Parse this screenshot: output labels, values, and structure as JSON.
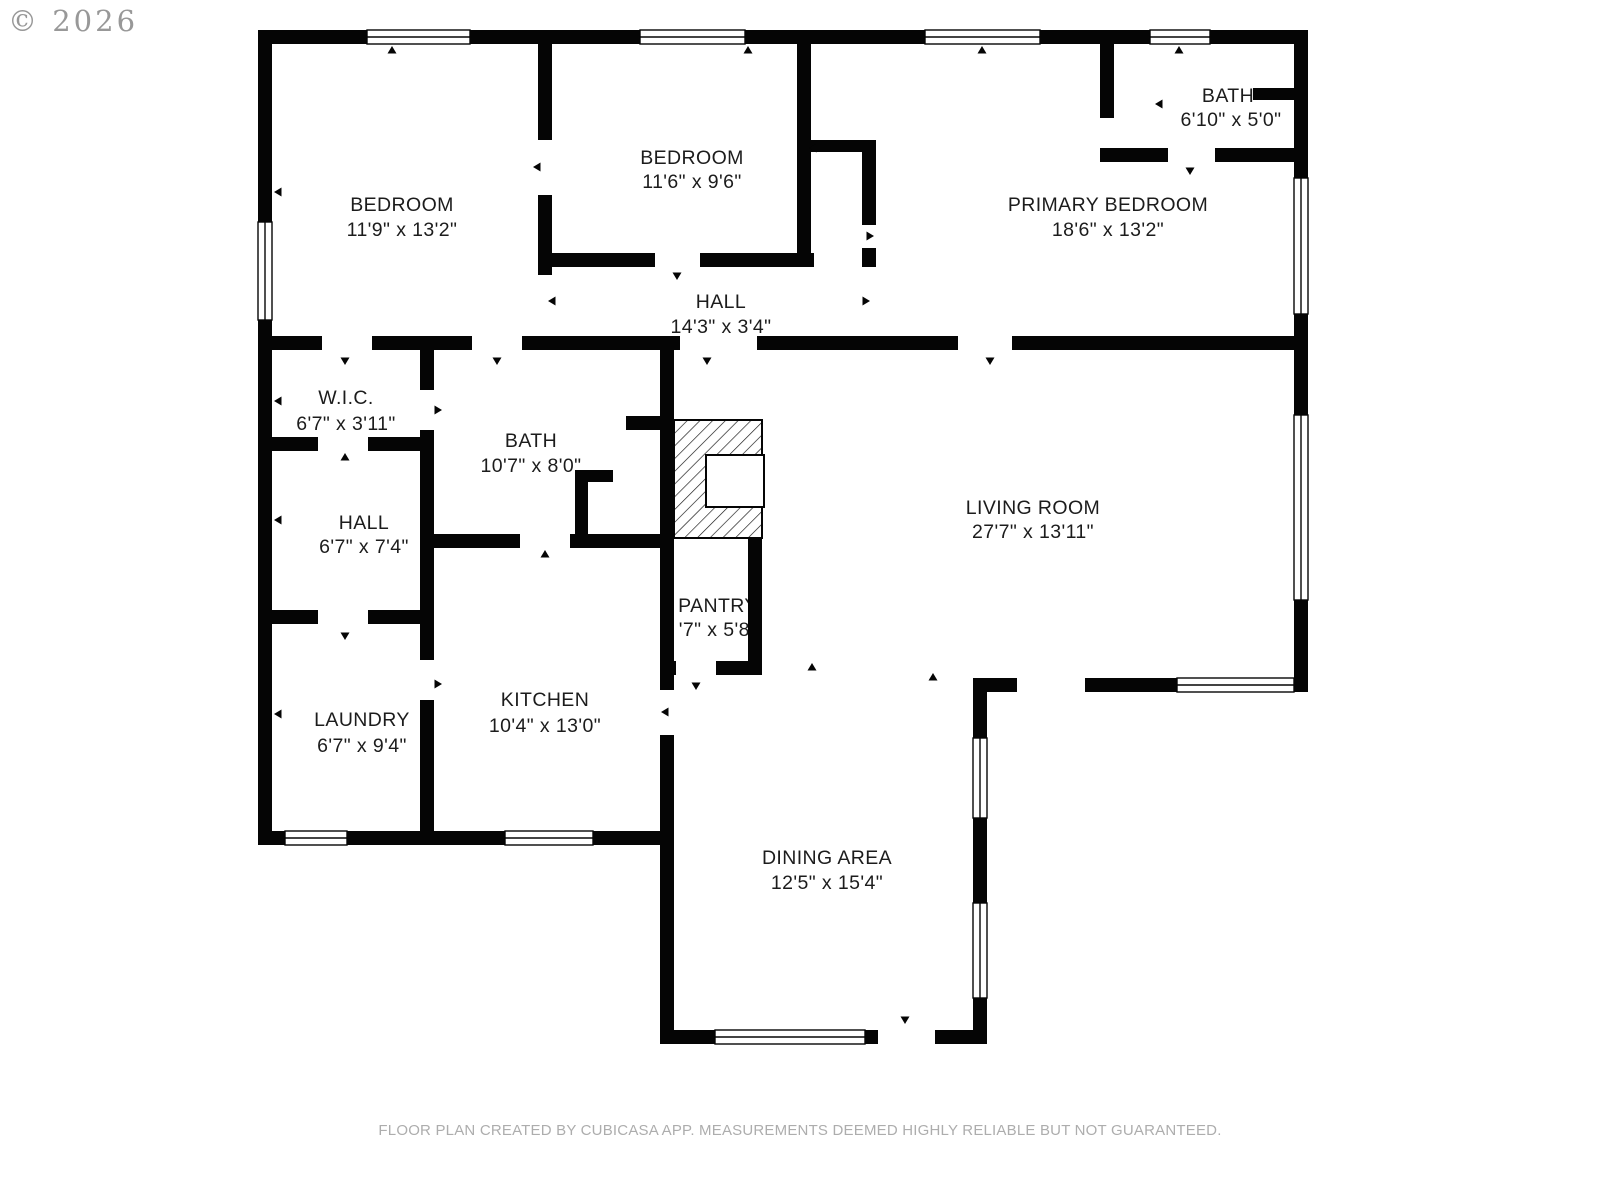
{
  "meta": {
    "copyright": "© 2026",
    "footer": "FLOOR PLAN CREATED BY CUBICASA APP. MEASUREMENTS DEEMED HIGHLY RELIABLE BUT NOT GUARANTEED."
  },
  "colors": {
    "wall": "#050505",
    "label": "#1c1c1c",
    "muted": "#adadad",
    "background": "#ffffff"
  },
  "rooms": [
    {
      "id": "bedroom-1",
      "name": "BEDROOM",
      "dims": "11'9\" x 13'2\""
    },
    {
      "id": "bedroom-2",
      "name": "BEDROOM",
      "dims": "11'6\" x 9'6\""
    },
    {
      "id": "bath-1",
      "name": "BATH",
      "dims": "6'10\" x 5'0\""
    },
    {
      "id": "primary-bedroom",
      "name": "PRIMARY BEDROOM",
      "dims": "18'6\" x 13'2\""
    },
    {
      "id": "hall-upper",
      "name": "HALL",
      "dims": "14'3\" x 3'4\""
    },
    {
      "id": "wic",
      "name": "W.I.C.",
      "dims": "6'7\" x 3'11\""
    },
    {
      "id": "bath-2",
      "name": "BATH",
      "dims": "10'7\" x 8'0\""
    },
    {
      "id": "hall-lower",
      "name": "HALL",
      "dims": "6'7\" x 7'4\""
    },
    {
      "id": "living-room",
      "name": "LIVING ROOM",
      "dims": "27'7\" x 13'11\""
    },
    {
      "id": "pantry",
      "name": "PANTRY",
      "dims": "'7\" x 5'8\""
    },
    {
      "id": "laundry",
      "name": "LAUNDRY",
      "dims": "6'7\" x 9'4\""
    },
    {
      "id": "kitchen",
      "name": "KITCHEN",
      "dims": "10'4\" x 13'0\""
    },
    {
      "id": "dining-area",
      "name": "DINING AREA",
      "dims": "12'5\" x 15'4\""
    }
  ]
}
